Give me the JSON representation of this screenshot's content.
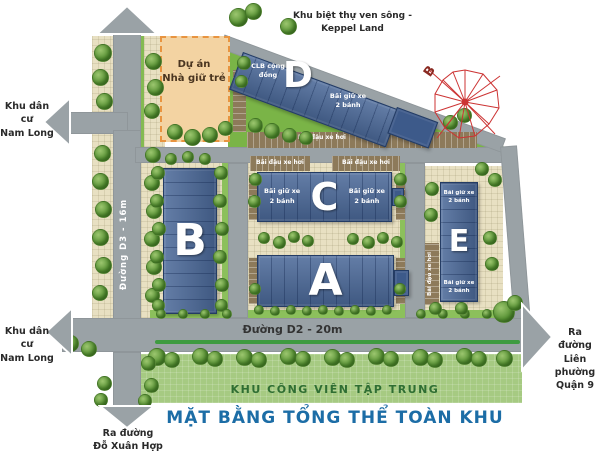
{
  "title": "MẶT BẰNG TỔNG THỂ TOÀN KHU",
  "colors": {
    "building_blue": "#4a6898",
    "road_gray": "#9aa2a6",
    "lawn_green": "#7ab447",
    "park_green": "#a6ca82",
    "sidewalk_beige": "#e8e0c2",
    "parking_brown": "#8d7a5a",
    "project_fill": "#f3d3a2",
    "project_border": "#e89440",
    "title_blue": "#1c6da6",
    "median_green": "#3e9b40",
    "compass_red": "#cc3333"
  },
  "labels": {
    "keppel_line1": "Khu biệt thự ven sông -",
    "keppel_line2": "Keppel Land",
    "nam_long_line1": "Khu dân cư",
    "nam_long_line2": "Nam Long",
    "kindergarten_line1": "Dự án",
    "kindergarten_line2": "Nhà giữ trẻ",
    "clb_line1": "CLB cộng",
    "clb_line2": "đồng",
    "moto_line1": "Bãi giữ xe",
    "moto_line2": "2 bánh",
    "car_parking": "Bãi đậu xe hơi",
    "road_d3": "Đường D3 - 16m",
    "road_d2": "Đường D2 - 20m",
    "exit_lp_line1": "Ra đường",
    "exit_lp_line2": "Liên phường",
    "exit_lp_line3": "Quận 9",
    "exit_dxh_line1": "Ra đường",
    "exit_dxh_line2": "Đỗ Xuân Hợp",
    "park": "KHU CÔNG VIÊN TẬP TRUNG",
    "compass_north": "B"
  },
  "buildings": {
    "a": "A",
    "b": "B",
    "c": "C",
    "d": "D",
    "e": "E"
  }
}
